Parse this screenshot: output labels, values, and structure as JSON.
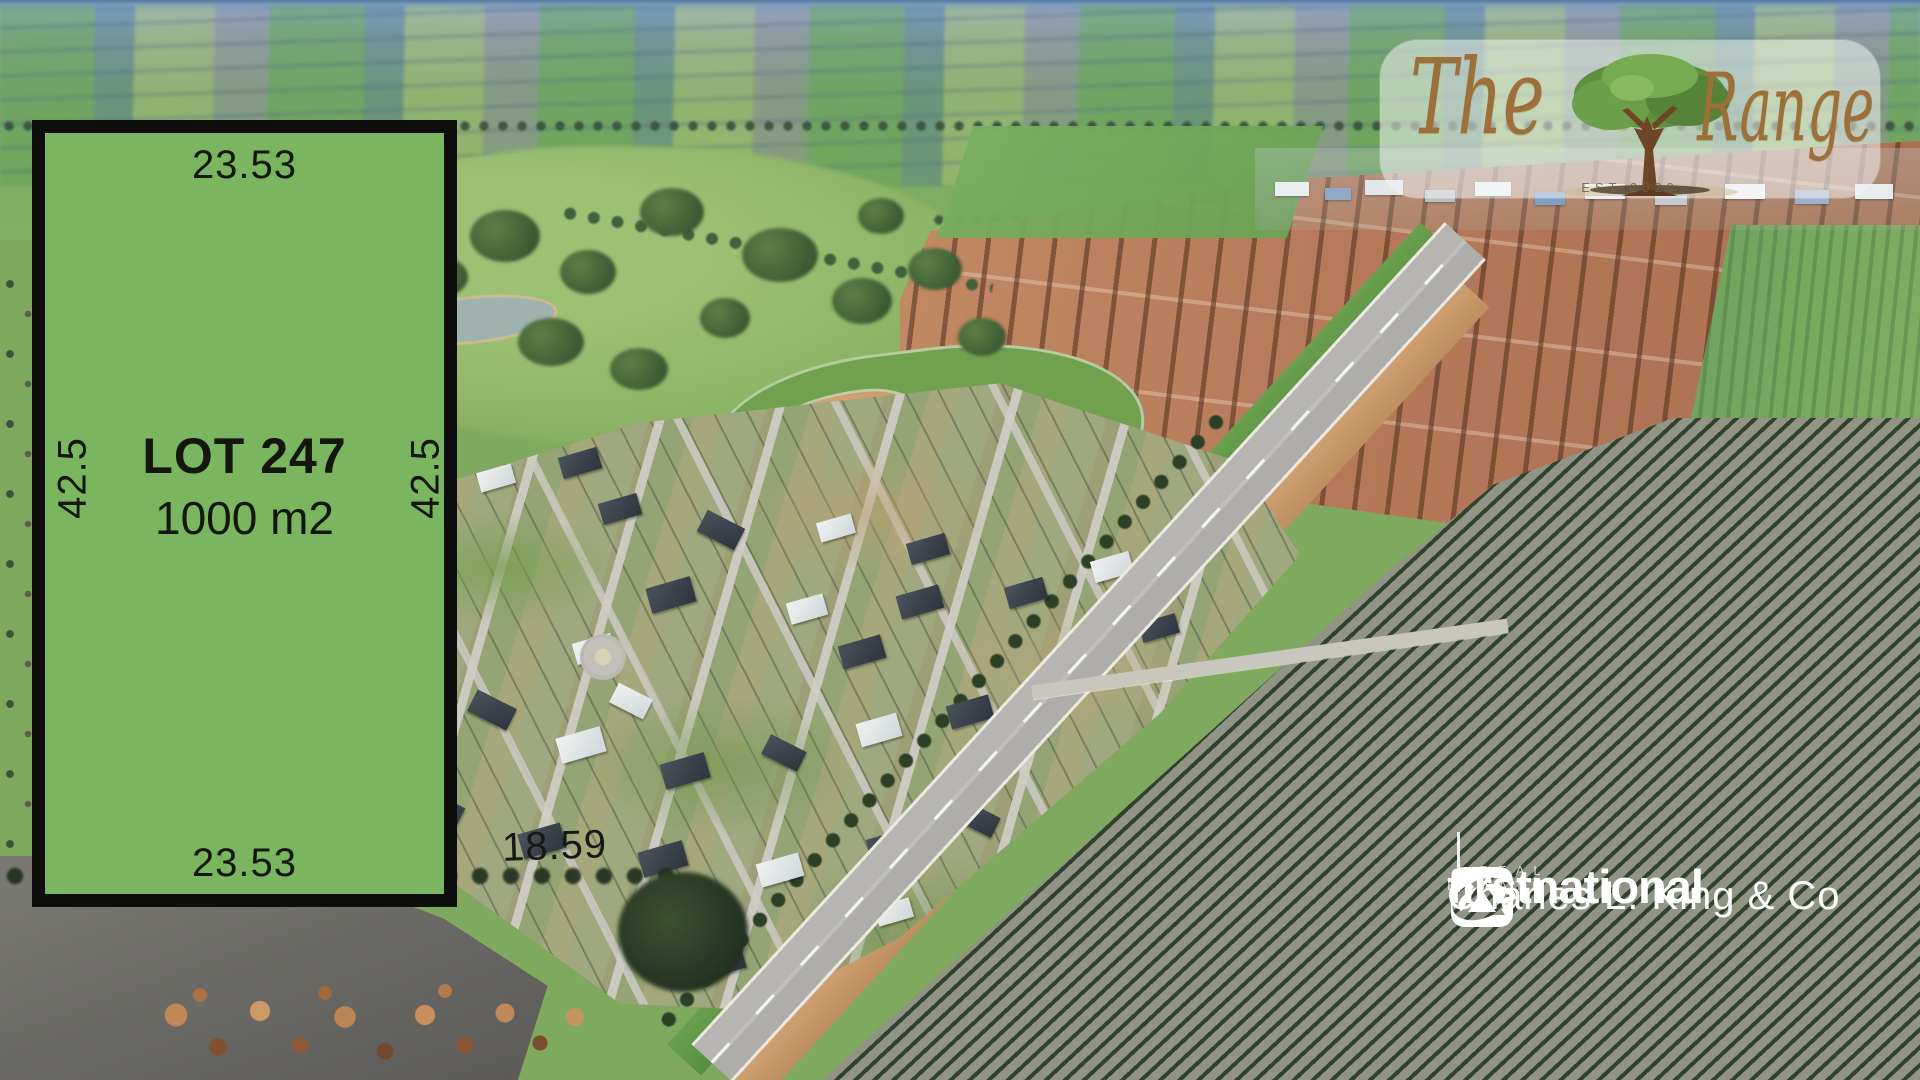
{
  "lot": {
    "name": "LOT 247",
    "area": "1000 m2",
    "width_top": "23.53",
    "width_bottom": "23.53",
    "depth_left": "42.5",
    "depth_right": "42.5",
    "frontage_note": "18.59",
    "fill_color": "#7ab55f",
    "border_color": "#0d0e0c",
    "text_color": "#15160f"
  },
  "estate_logo": {
    "word_the": "The",
    "word_range": "Range",
    "established": "EST 2020",
    "script_color": "#9c7038",
    "icon": "oak-tree-icon"
  },
  "agency": {
    "brand": "firstnational",
    "brand_sub": "REAL ESTATE",
    "office": "Charles L. King & Co",
    "text_color": "#ffffff",
    "icon": "first-national-icon"
  }
}
